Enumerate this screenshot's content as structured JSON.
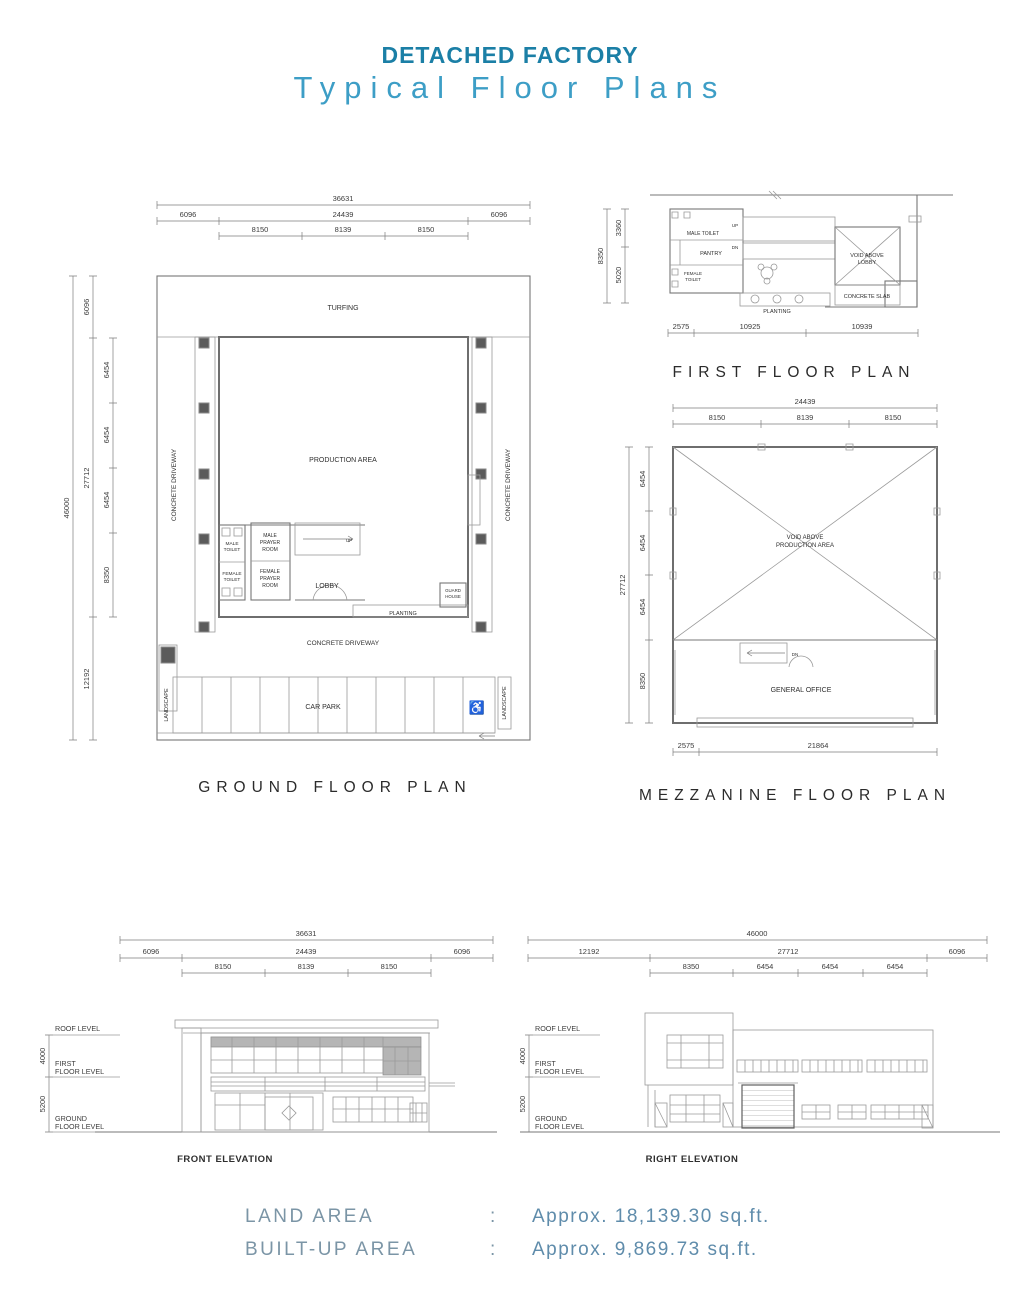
{
  "header": {
    "title": "DETACHED FACTORY",
    "subtitle": "Typical Floor Plans"
  },
  "colors": {
    "title_accent": "#1b7fa6",
    "subtitle_accent": "#3d9ec6",
    "summary_label": "#7b95a6",
    "summary_value": "#5f8cab",
    "drawing_line": "#9a9a9a",
    "drawing_text": "#3c3c3c"
  },
  "ground_floor": {
    "title": "GROUND FLOOR PLAN",
    "dim_top_total": "36631",
    "dim_top_mid": [
      "6096",
      "24439",
      "6096"
    ],
    "dim_top_bays": [
      "8150",
      "8139",
      "8150"
    ],
    "dim_left_total": "46000",
    "dim_left_mid": [
      "6096",
      "27712",
      "12192"
    ],
    "dim_left_bays": [
      "6454",
      "6454",
      "6454",
      "8350"
    ],
    "labels": {
      "turfing": "TURFING",
      "production_area": "PRODUCTION AREA",
      "concrete_driveway_left": "CONCRETE DRIVEWAY",
      "concrete_driveway_right": "CONCRETE DRIVEWAY",
      "concrete_driveway_bottom": "CONCRETE DRIVEWAY",
      "male_toilet_1": "MALE",
      "male_toilet_2": "TOILET",
      "female_toilet_1": "FEMALE",
      "female_toilet_2": "TOILET",
      "male_prayer_1": "MALE",
      "male_prayer_2": "PRAYER",
      "male_prayer_3": "ROOM",
      "female_prayer_1": "FEMALE",
      "female_prayer_2": "PRAYER",
      "female_prayer_3": "ROOM",
      "lobby": "LOBBY",
      "up": "UP",
      "planting": "PLANTING",
      "guard_house_1": "GUARD",
      "guard_house_2": "HOUSE",
      "car_park": "CAR PARK",
      "landscape_left": "LANDSCAPE",
      "landscape_right": "LANDSCAPE"
    },
    "icons": {
      "handicap": "♿"
    }
  },
  "first_floor": {
    "title": "FIRST FLOOR PLAN",
    "dim_left_total": "8350",
    "dim_left_bays": [
      "3360",
      "5020"
    ],
    "dim_bottom": [
      "2575",
      "10925",
      "10939"
    ],
    "labels": {
      "male_toilet": "MALE TOILET",
      "pantry": "PANTRY",
      "female_toilet_1": "FEMALE",
      "female_toilet_2": "TOILET",
      "up": "UP",
      "dn": "DN",
      "void_1": "VOID ABOVE",
      "void_2": "LOBBY",
      "concrete_slab": "CONCRETE SLAB",
      "planting": "PLANTING"
    }
  },
  "mezzanine": {
    "title": "MEZZANINE FLOOR PLAN",
    "dim_top_total": "24439",
    "dim_top_bays": [
      "8150",
      "8139",
      "8150"
    ],
    "dim_left_total": "27712",
    "dim_left_bays": [
      "6454",
      "6454",
      "6454",
      "8350"
    ],
    "dim_bottom": [
      "2575",
      "21864"
    ],
    "labels": {
      "void_1": "VOID ABOVE",
      "void_2": "PRODUCTION AREA",
      "general_office": "GENERAL OFFICE",
      "dn": "DN"
    }
  },
  "front_elevation": {
    "title": "FRONT ELEVATION",
    "dim_top_total": "36631",
    "dim_top_mid": [
      "6096",
      "24439",
      "6096"
    ],
    "dim_top_bays": [
      "8150",
      "8139",
      "8150"
    ],
    "dim_heights": [
      "4000",
      "5200"
    ],
    "levels": {
      "roof": "ROOF LEVEL",
      "first_1": "FIRST",
      "first_2": "FLOOR LEVEL",
      "ground_1": "GROUND",
      "ground_2": "FLOOR LEVEL"
    }
  },
  "right_elevation": {
    "title": "RIGHT ELEVATION",
    "dim_top_total": "46000",
    "dim_top_mid": [
      "12192",
      "27712",
      "6096"
    ],
    "dim_top_bays": [
      "8350",
      "6454",
      "6454",
      "6454"
    ],
    "dim_heights": [
      "4000",
      "5200"
    ],
    "levels": {
      "roof": "ROOF LEVEL",
      "first_1": "FIRST",
      "first_2": "FLOOR LEVEL",
      "ground_1": "GROUND",
      "ground_2": "FLOOR LEVEL"
    }
  },
  "summary": {
    "rows": [
      {
        "label": "LAND AREA",
        "sep": ":",
        "value": "Approx. 18,139.30 sq.ft."
      },
      {
        "label": "BUILT-UP AREA",
        "sep": ":",
        "value": "Approx. 9,869.73 sq.ft."
      }
    ]
  }
}
